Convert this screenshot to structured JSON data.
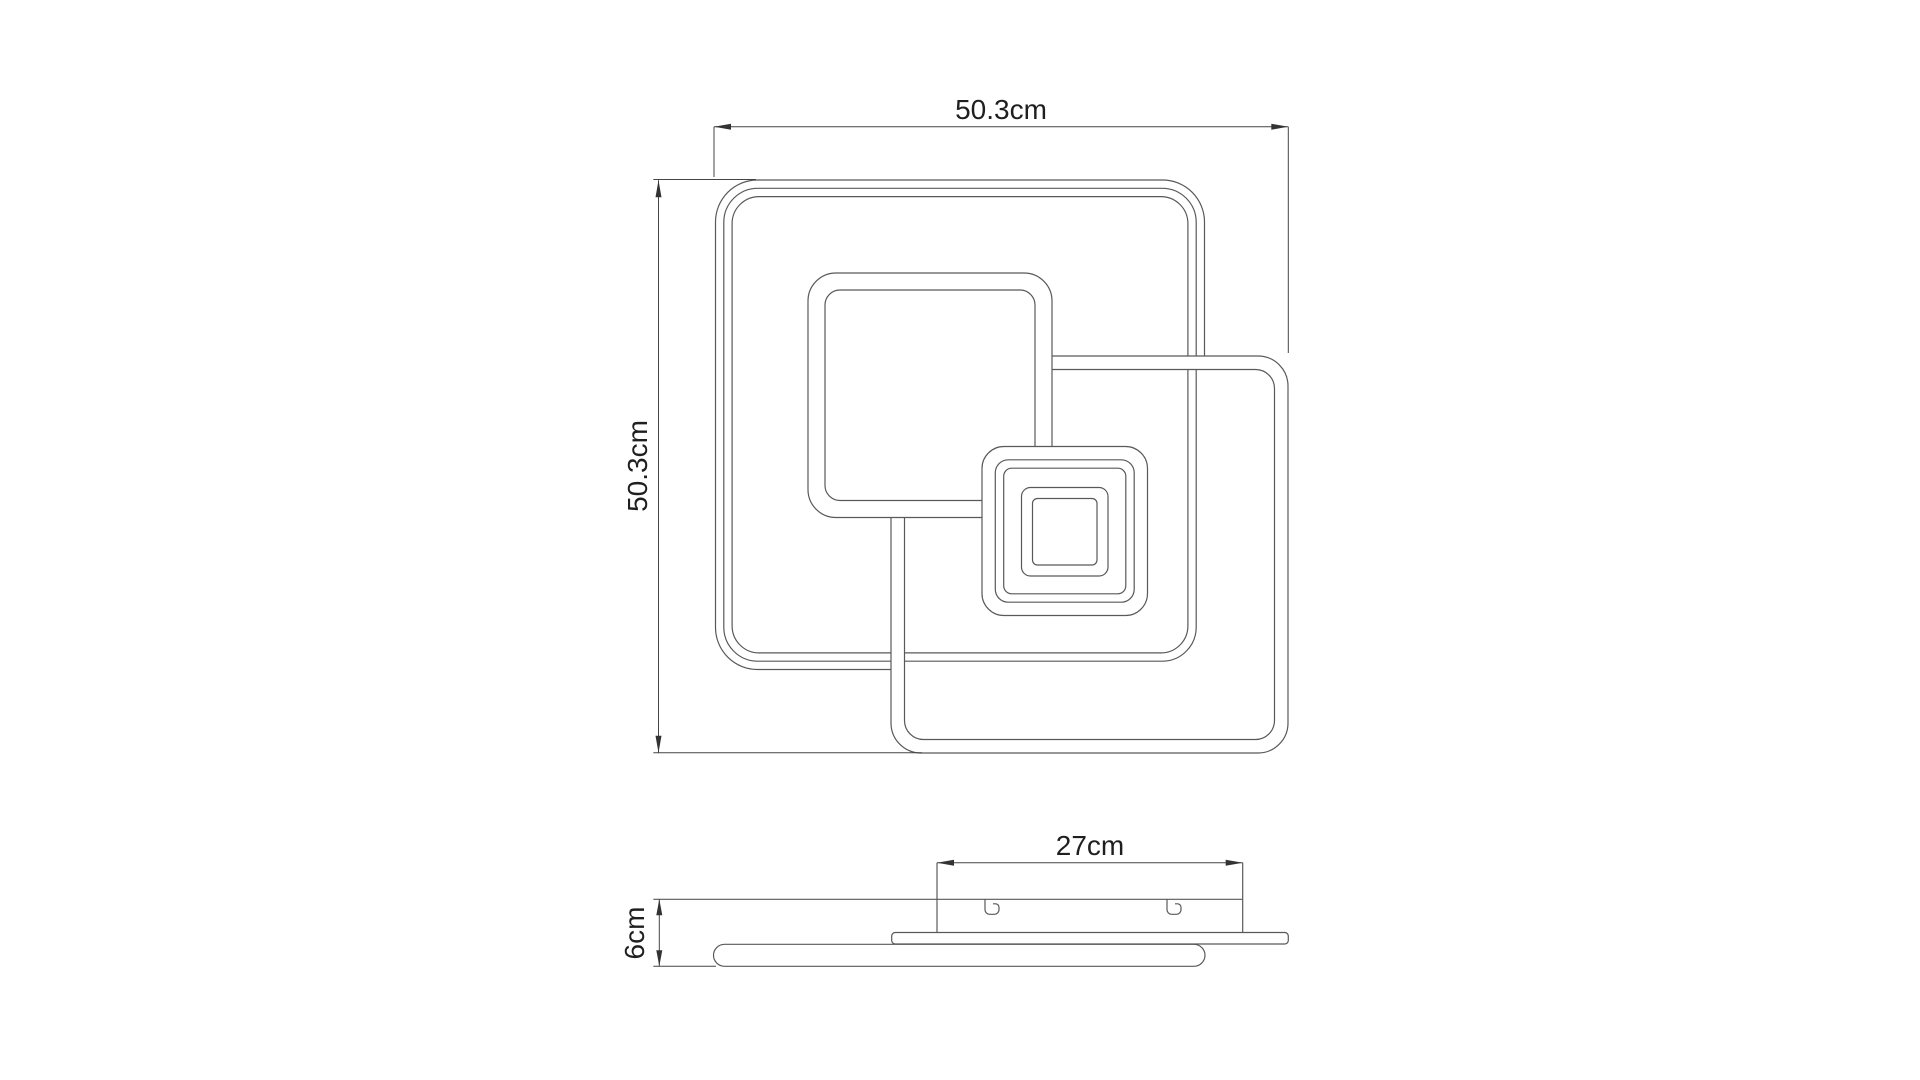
{
  "page": {
    "background_color": "#ffffff",
    "line_color": "#595959",
    "dimension_line_color": "#454545",
    "text_color": "#1f1f1f",
    "description": "Technical dimension drawing of square LED ceiling lamp, top view and side view"
  },
  "top_view": {
    "width_label": "50.3cm",
    "height_label": "50.3cm"
  },
  "side_view": {
    "bracket_width_label": "27cm",
    "height_label": "6cm"
  }
}
